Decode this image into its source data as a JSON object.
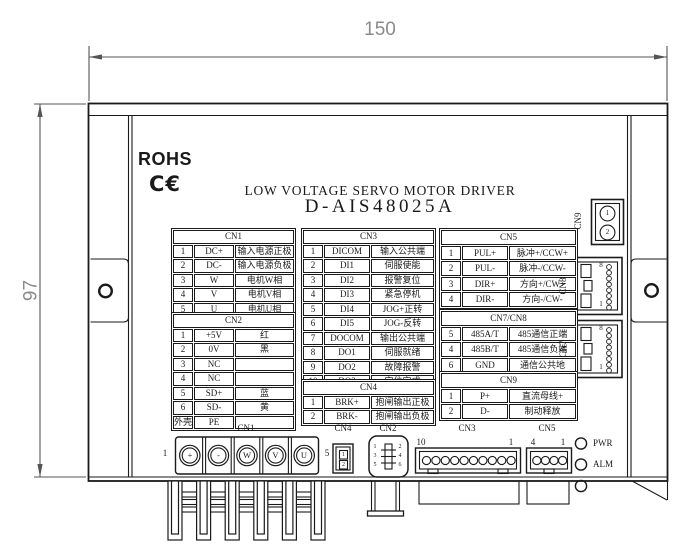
{
  "colors": {
    "line": "#1a1a1a",
    "dimension": "#8a8a8a",
    "background": "#ffffff"
  },
  "dimensions": {
    "width_label": "150",
    "height_label": "97"
  },
  "header": {
    "rohs": "ROHS",
    "ce_mark": "C€",
    "title": "LOW VOLTAGE SERVO MOTOR DRIVER",
    "model": "D-AIS48025A"
  },
  "tables": {
    "cn1": {
      "title": "CN1",
      "rows": [
        [
          "1",
          "DC+",
          "输入电源正极"
        ],
        [
          "2",
          "DC-",
          "输入电源负极"
        ],
        [
          "3",
          "W",
          "电机W相"
        ],
        [
          "4",
          "V",
          "电机V相"
        ],
        [
          "5",
          "U",
          "电机U相"
        ]
      ]
    },
    "cn2": {
      "title": "CN2",
      "rows": [
        [
          "1",
          "+5V",
          "红"
        ],
        [
          "2",
          "0V",
          "黑"
        ],
        [
          "3",
          "NC",
          ""
        ],
        [
          "4",
          "NC",
          ""
        ],
        [
          "5",
          "SD+",
          "蓝"
        ],
        [
          "6",
          "SD-",
          "黄"
        ],
        [
          "外壳",
          "PE",
          ""
        ]
      ]
    },
    "cn3": {
      "title": "CN3",
      "rows": [
        [
          "1",
          "DICOM",
          "输入公共端"
        ],
        [
          "2",
          "DI1",
          "伺服使能"
        ],
        [
          "3",
          "DI2",
          "报警复位"
        ],
        [
          "4",
          "DI3",
          "紧急停机"
        ],
        [
          "5",
          "DI4",
          "JOG+正转"
        ],
        [
          "6",
          "DI5",
          "JOG-反转"
        ],
        [
          "7",
          "DOCOM",
          "输出公共端"
        ],
        [
          "8",
          "DO1",
          "伺服就绪"
        ],
        [
          "9",
          "DO2",
          "故障报警"
        ],
        [
          "10",
          "DO3",
          "定位完成"
        ]
      ]
    },
    "cn4": {
      "title": "CN4",
      "rows": [
        [
          "1",
          "BRK+",
          "抱闸输出正极"
        ],
        [
          "2",
          "BRK-",
          "抱闸输出负极"
        ]
      ]
    },
    "cn5": {
      "title": "CN5",
      "rows": [
        [
          "1",
          "PUL+",
          "脉冲+/CCW+"
        ],
        [
          "2",
          "PUL-",
          "脉冲-/CCW-"
        ],
        [
          "3",
          "DIR+",
          "方向+/CW+"
        ],
        [
          "4",
          "DIR-",
          "方向-/CW-"
        ]
      ]
    },
    "cn7cn8": {
      "title": "CN7/CN8",
      "rows": [
        [
          "5",
          "485A/T",
          "485通信正端"
        ],
        [
          "4",
          "485B/T",
          "485通信负端"
        ],
        [
          "6",
          "GND",
          "通信公共地"
        ]
      ]
    },
    "cn9": {
      "title": "CN9",
      "rows": [
        [
          "1",
          "P+",
          "直流母线+"
        ],
        [
          "2",
          "D-",
          "制动释放"
        ]
      ]
    }
  },
  "side_connectors": {
    "cn9": {
      "label": "CN9",
      "pin1": "1",
      "pin2": "2"
    },
    "cn8": {
      "label": "CN8",
      "pin_top": "8",
      "pin_bottom": "1"
    },
    "cn7": {
      "label": "CN7",
      "pin_top": "8",
      "pin_bottom": "1"
    }
  },
  "bottom_connectors": {
    "cn1": {
      "label": "CN1",
      "first_pin": "1",
      "last_pin": "5",
      "terminals": [
        "+",
        "-",
        "W",
        "V",
        "U"
      ]
    },
    "cn4": {
      "label": "CN4",
      "pin1": "1",
      "pin2": "2"
    },
    "cn2": {
      "label": "CN2",
      "pins": [
        "1",
        "2",
        "3",
        "4",
        "5",
        "6"
      ]
    },
    "cn3": {
      "label": "CN3",
      "left_pin": "10",
      "right_pin": "1",
      "pin_count": 10
    },
    "cn5": {
      "label": "CN5",
      "left_pin": "4",
      "right_pin": "1",
      "pin_count": 4
    },
    "led_pwr": "PWR",
    "led_alm": "ALM"
  }
}
